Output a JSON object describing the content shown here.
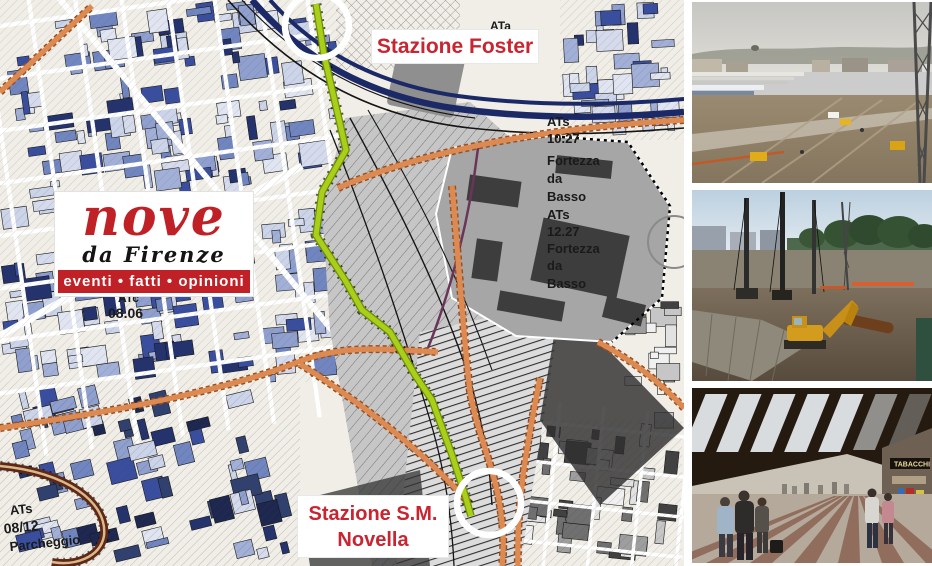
{
  "colors": {
    "label_red": "#c92530",
    "logo_red": "#bf2126",
    "route_green": "#aacf1b",
    "road_orange": "#dd8a52",
    "rail_navy": "#1b2a66"
  },
  "map": {
    "station_labels": {
      "foster": "Stazione Foster",
      "smn_line1": "Stazione S.M.",
      "smn_line2": "Novella"
    },
    "annotations": {
      "ata": "ATa",
      "fortezza_block": [
        "ATs",
        "10.27",
        "Fortezza",
        "da",
        "Basso",
        "ATs",
        "12.27",
        "Fortezza",
        "da",
        "Basso"
      ],
      "atc": "ATc",
      "atc_num": "08.06",
      "parcheggio": [
        "ATs",
        "08/12",
        "Parcheggio"
      ]
    }
  },
  "logo": {
    "title": "nove",
    "subtitle": "da Firenze",
    "tagline": "eventi • fatti • opinioni"
  },
  "photos": [
    {
      "name": "construction-site-aerial-photo"
    },
    {
      "name": "construction-drill-rigs-photo"
    },
    {
      "name": "station-concourse-photo",
      "sign": "TABACCHI"
    }
  ]
}
